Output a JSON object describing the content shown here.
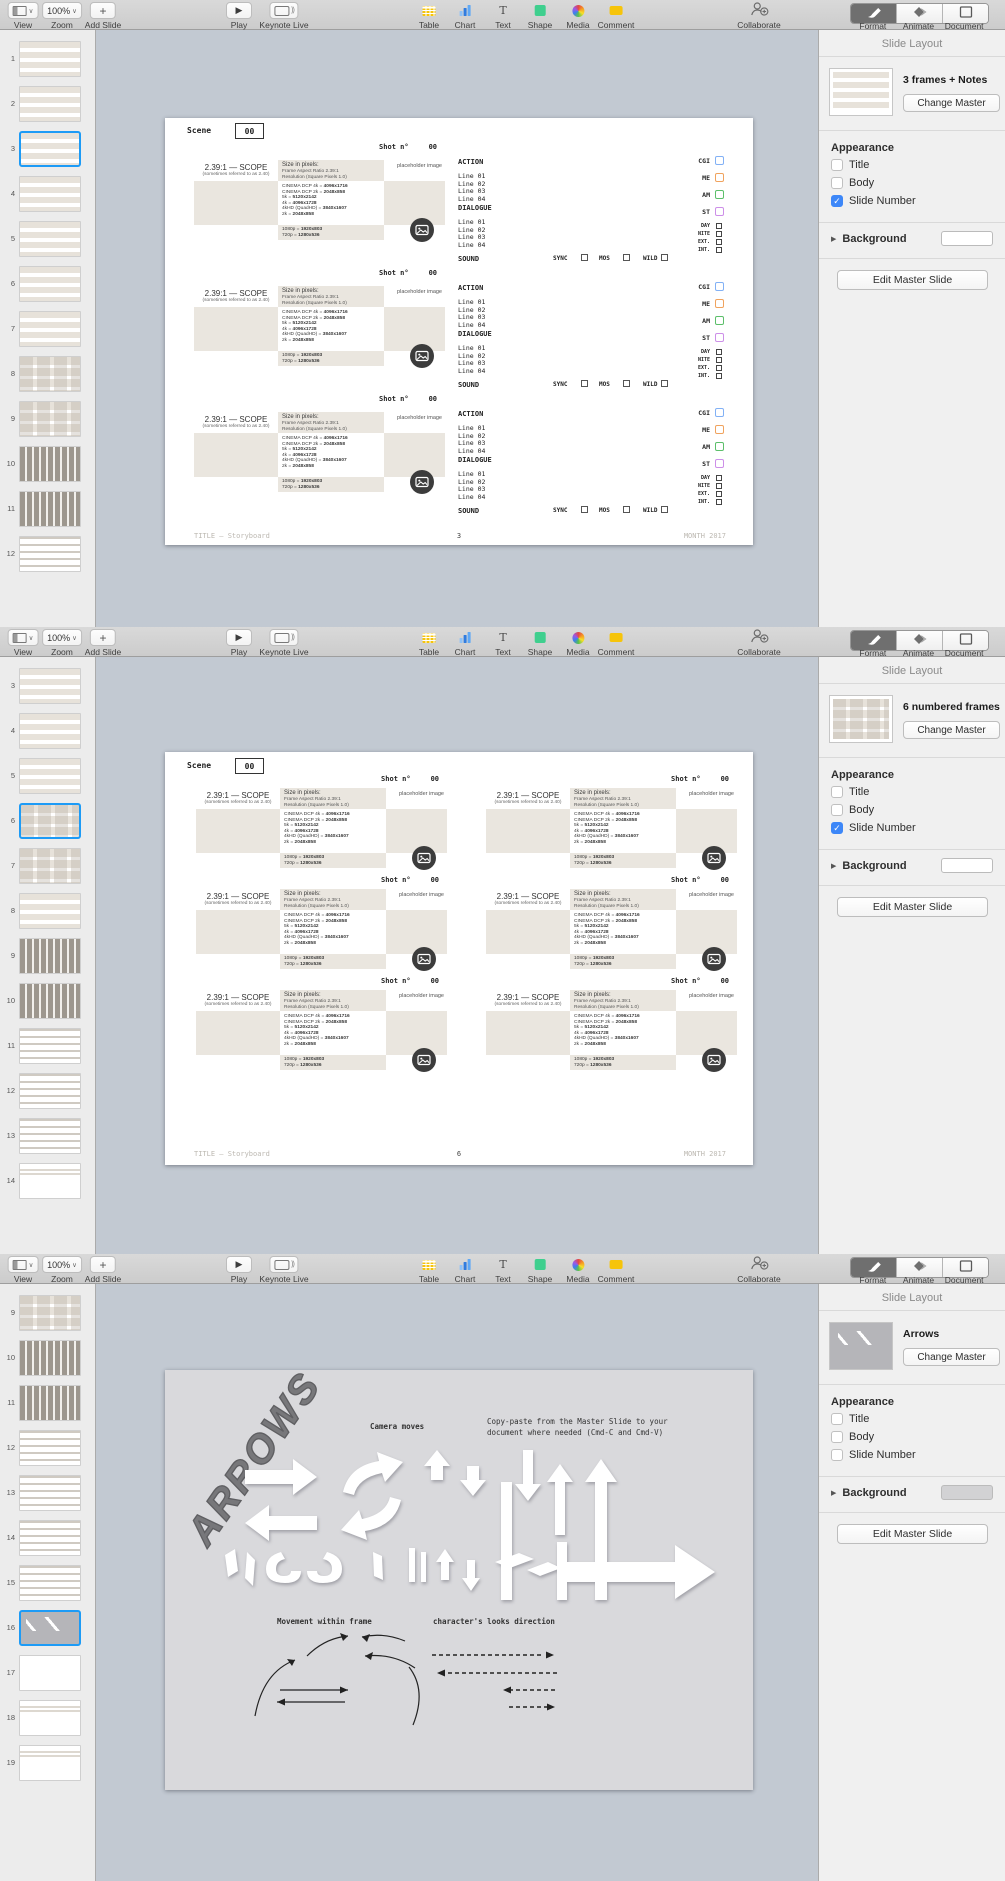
{
  "toolbar": {
    "view_label": "View",
    "zoom_label": "Zoom",
    "zoom_value": "100%",
    "add_slide_label": "Add Slide",
    "play_label": "Play",
    "keynote_live_label": "Keynote Live",
    "insert_tools": [
      "Table",
      "Chart",
      "Text",
      "Shape",
      "Media",
      "Comment"
    ],
    "collaborate_label": "Collaborate",
    "inspector_tabs": [
      "Format",
      "Animate",
      "Document"
    ],
    "active_tab": "Format"
  },
  "panel_labels": {
    "title": "Slide Layout",
    "change_master": "Change Master",
    "appearance": "Appearance",
    "options": [
      "Title",
      "Body",
      "Slide Number"
    ],
    "background": "Background",
    "edit_master": "Edit Master Slide"
  },
  "storyboard": {
    "scene_label": "Scene",
    "scene_value": "00",
    "shot_label": "Shot n°",
    "shot_value": "00",
    "aspect_title": "2.39:1 — SCOPE",
    "aspect_subtitle": "(sometimes referred to as 2.40)",
    "size_header": [
      "Size in pixels:",
      "Frame Aspect Ratio 2.39:1",
      "Resolution (Square Pixels 1.0)"
    ],
    "resolutions": [
      "CINEMA DCP 4k = 4096x1716",
      "CINEMA DCP 2k = 2048x858",
      "5k = 5120x2142",
      "4k = 4096x1728",
      "4kHD (QuadHD) = 3840x1607",
      "2k = 2048x858"
    ],
    "resolutions_footer": [
      "1080p = 1920x803",
      "720p = 1280x536"
    ],
    "placeholder_label": "placeholder image",
    "action_label": "ACTION",
    "dialogue_label": "DIALOGUE",
    "sound_label": "SOUND",
    "lines": [
      "Line 01",
      "Line 02",
      "Line 03",
      "Line 04"
    ],
    "sound_options": [
      "SYNC",
      "MOS",
      "WILD"
    ],
    "tags_colored": [
      {
        "label": "CGI",
        "color": "#82b1f5"
      },
      {
        "label": "ME",
        "color": "#f0a35e"
      },
      {
        "label": "AM",
        "color": "#5cbf6a"
      },
      {
        "label": "ST",
        "color": "#cd8fe8"
      }
    ],
    "tags_small": [
      "DAY",
      "NITE",
      "EXT.",
      "INT."
    ],
    "footer_left": "TITLE — Storyboard",
    "footer_right": "MONTH 2017"
  },
  "arrows_slide": {
    "title": "ARROWS",
    "camera_moves_label": "Camera moves",
    "copy_note_lines": [
      "Copy-paste from the Master Slide to your",
      "document where needed (Cmd-C and Cmd-V)"
    ],
    "movement_label": "Movement within frame",
    "looks_label": "character's looks direction"
  },
  "windows": [
    {
      "slide_type": "story3",
      "page_number": "3",
      "panel": {
        "master_name": "3 frames + Notes",
        "thumb": "story3notes",
        "checks": [
          false,
          false,
          true
        ],
        "background_color": "#ffffff"
      },
      "sidebar": {
        "selected": 3,
        "slides": [
          {
            "n": "1",
            "kind": "story3"
          },
          {
            "n": "2",
            "kind": "story3"
          },
          {
            "n": "3",
            "kind": "story3"
          },
          {
            "n": "4",
            "kind": "story3"
          },
          {
            "n": "5",
            "kind": "story3"
          },
          {
            "n": "6",
            "kind": "story3"
          },
          {
            "n": "7",
            "kind": "story3"
          },
          {
            "n": "8",
            "kind": "frames6"
          },
          {
            "n": "9",
            "kind": "frames6"
          },
          {
            "n": "10",
            "kind": "grid"
          },
          {
            "n": "11",
            "kind": "grid"
          },
          {
            "n": "12",
            "kind": "links"
          }
        ]
      }
    },
    {
      "slide_type": "story6",
      "page_number": "6",
      "panel": {
        "master_name": "6 numbered frames",
        "thumb": "frames6",
        "checks": [
          false,
          false,
          true
        ],
        "background_color": "#ffffff"
      },
      "sidebar": {
        "selected": 6,
        "slides": [
          {
            "n": "3",
            "kind": "story3"
          },
          {
            "n": "4",
            "kind": "story3"
          },
          {
            "n": "5",
            "kind": "story3"
          },
          {
            "n": "6",
            "kind": "frames6"
          },
          {
            "n": "7",
            "kind": "frames6"
          },
          {
            "n": "8",
            "kind": "story3"
          },
          {
            "n": "9",
            "kind": "grid"
          },
          {
            "n": "10",
            "kind": "grid"
          },
          {
            "n": "11",
            "kind": "links"
          },
          {
            "n": "12",
            "kind": "links"
          },
          {
            "n": "13",
            "kind": "links"
          },
          {
            "n": "14",
            "kind": "doc"
          }
        ]
      }
    },
    {
      "slide_type": "arrows",
      "page_number": "",
      "panel": {
        "master_name": "Arrows",
        "thumb": "arrows",
        "checks": [
          false,
          false,
          false
        ],
        "background_color": "#d2d2d4"
      },
      "sidebar": {
        "selected": 16,
        "slides": [
          {
            "n": "9",
            "kind": "frames6"
          },
          {
            "n": "10",
            "kind": "grid"
          },
          {
            "n": "11",
            "kind": "grid"
          },
          {
            "n": "12",
            "kind": "links"
          },
          {
            "n": "13",
            "kind": "links"
          },
          {
            "n": "14",
            "kind": "links"
          },
          {
            "n": "15",
            "kind": "links"
          },
          {
            "n": "16",
            "kind": "arrows"
          },
          {
            "n": "17",
            "kind": "blank"
          },
          {
            "n": "18",
            "kind": "doc"
          },
          {
            "n": "19",
            "kind": "doc"
          }
        ]
      }
    }
  ]
}
